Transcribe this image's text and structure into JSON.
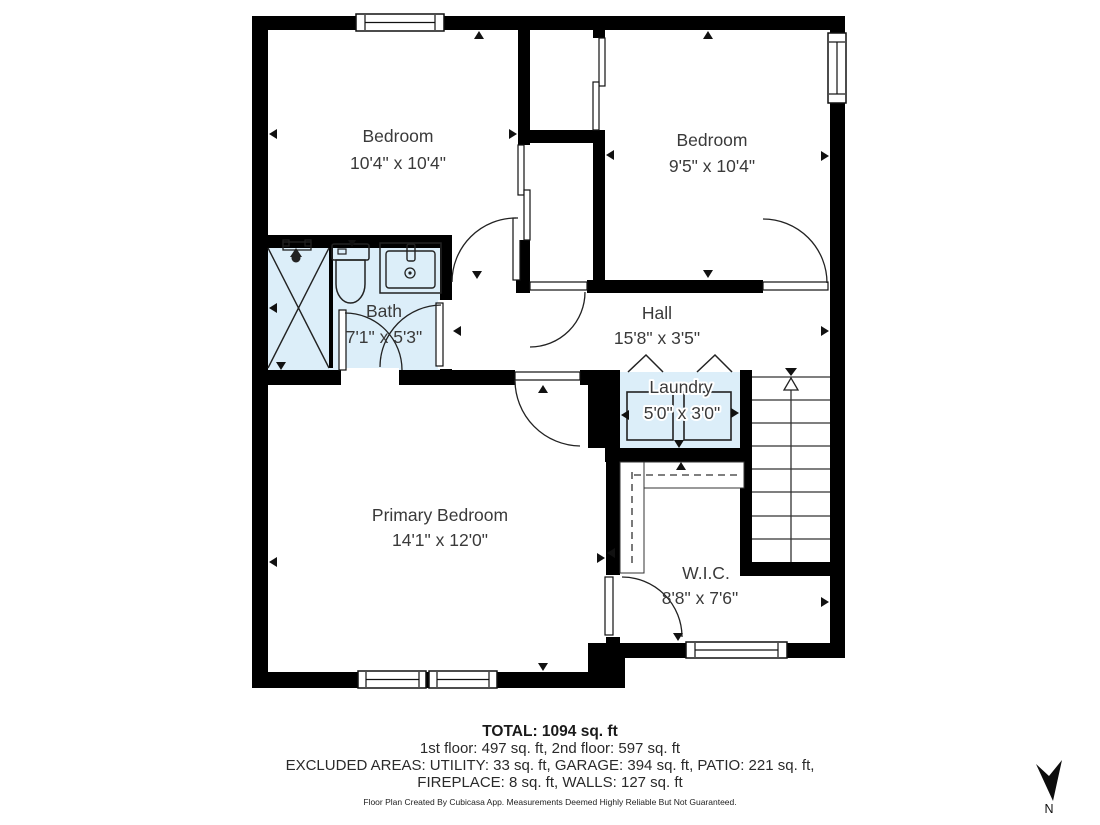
{
  "rooms": [
    {
      "name": "Bedroom",
      "dims": "10'4\" x 10'4\""
    },
    {
      "name": "Bedroom",
      "dims": "9'5\" x 10'4\""
    },
    {
      "name": "Bath",
      "dims": "7'1\" x 5'3\""
    },
    {
      "name": "Hall",
      "dims": "15'8\" x 3'5\""
    },
    {
      "name": "Laundry",
      "dims": "5'0\" x 3'0\""
    },
    {
      "name": "Primary Bedroom",
      "dims": "14'1\" x 12'0\""
    },
    {
      "name": "W.I.C.",
      "dims": "8'8\" x 7'6\""
    }
  ],
  "summary": {
    "total": "TOTAL: 1094 sq. ft",
    "floors": "1st floor: 497 sq. ft, 2nd floor: 597 sq. ft",
    "excluded_line1": "EXCLUDED AREAS: UTILITY: 33 sq. ft, GARAGE: 394 sq. ft, PATIO: 221 sq. ft,",
    "excluded_line2": "FIREPLACE: 8 sq. ft, WALLS: 127 sq. ft",
    "disclaimer": "Floor Plan Created By Cubicasa App. Measurements Deemed Highly Reliable But Not Guaranteed."
  },
  "compass": {
    "label": "N"
  },
  "colors": {
    "wall": "#000000",
    "wet_room_fill": "#dceef9",
    "label_text": "#3a3a3a"
  }
}
